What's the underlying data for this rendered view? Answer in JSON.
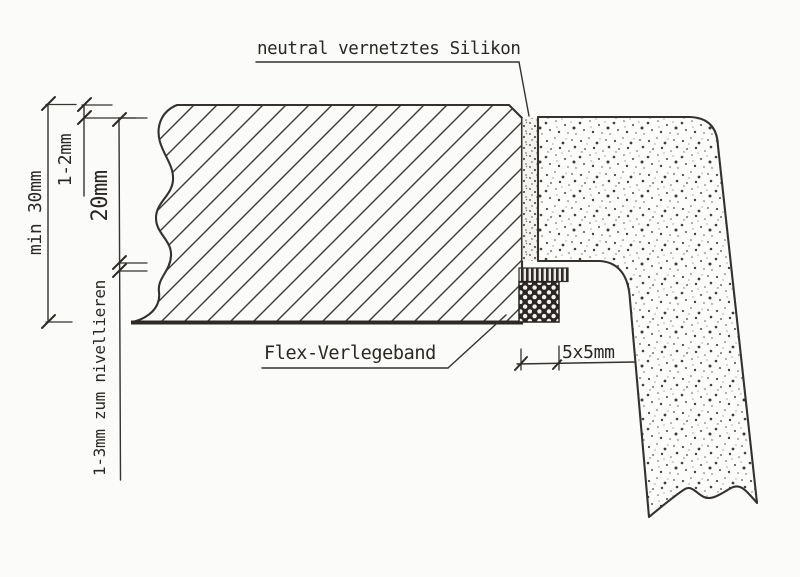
{
  "labels": {
    "silicone": "neutral vernetztes Silikon",
    "tape": "Flex-Verlegeband"
  },
  "dimensions": {
    "countertop_min_thickness": "min 30mm",
    "top_reveal_gap": "1-2mm",
    "panel_edge_depth": "20mm",
    "leveling_allowance": "1-3mm zum nivellieren",
    "tape_size": "5x5mm"
  },
  "colors": {
    "line": "#35322f",
    "text": "#2a2724",
    "background": "#fbfbf9"
  }
}
